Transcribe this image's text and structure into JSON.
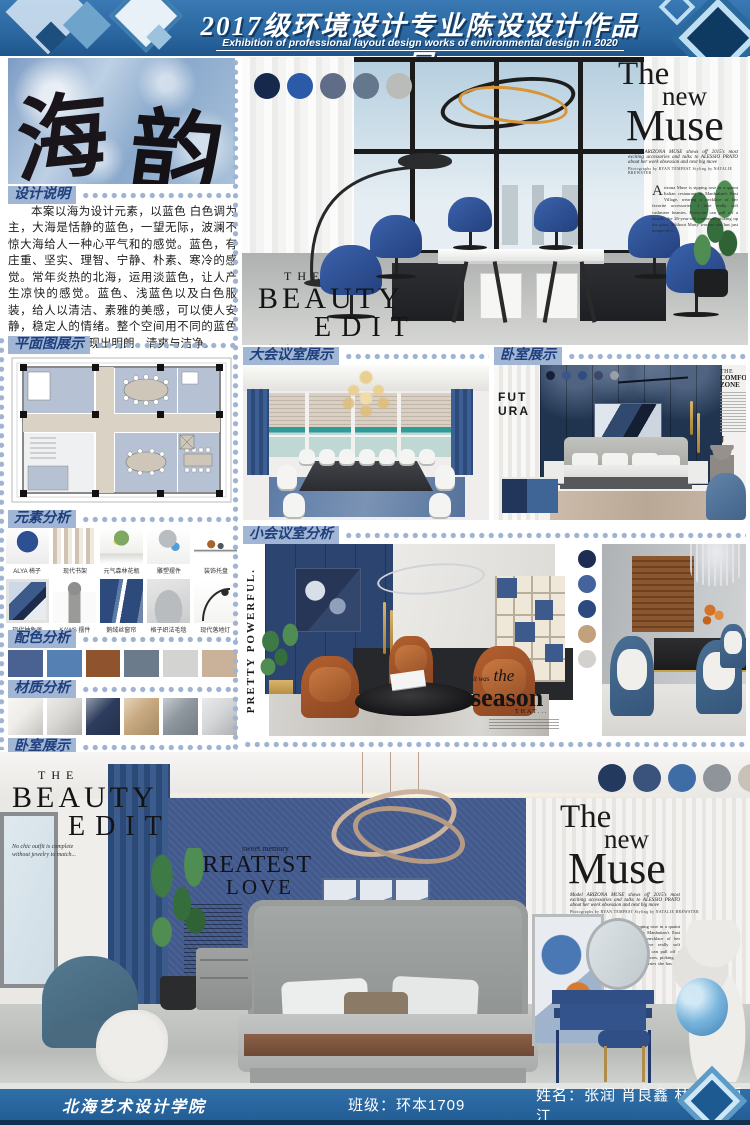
{
  "header": {
    "title": "2017级环境设计专业陈设设计作品展",
    "subtitle": "Exhibition of professional layout design works of environmental design in 2020"
  },
  "hero": {
    "char_left": "海",
    "char_right": "韵"
  },
  "design_notes": {
    "label": "设计说明",
    "body": "本案以海为设计元素，以蓝色 白色调为主，大海是恬静的蓝色，一望无际，波澜不惊大海给人一种心平气和的感觉。蓝色，有庄重、坚实、理智、宁静、朴素、寒冷的感觉。常年炎热的北海，运用淡蓝色，让人产生凉快的感觉。蓝色、浅蓝色以及白色服装，给人以清洁、素雅的美感，可以使人安静，稳定人的情绪。整个空间用不同的蓝色与白色相配，表现出明朗、清爽与洁净。"
  },
  "floor_plan": {
    "label": "平面图展示"
  },
  "elements": {
    "label": "元素分析",
    "items": [
      "ALYA 椅子",
      "现代书架",
      "元气森林花瓶",
      "雕塑摆件",
      "装饰托盘",
      "现代抽象画",
      "KAWS 摆件",
      "鹅绒丝窗帘",
      "格子织法毛毯",
      "现代落地灯"
    ]
  },
  "palette": {
    "label": "配色分析",
    "colors": [
      "#4a6291",
      "#5580b3",
      "#8f532e",
      "#6b7b8c",
      "#d3d3d1",
      "#c9b299"
    ]
  },
  "materials": {
    "label": "材质分析",
    "colors": [
      "#efede9",
      "#d9d7d3",
      "#2c3c5c",
      "#c8a87e",
      "#8e979e",
      "#d4d6d8"
    ]
  },
  "bedroom_preview": {
    "label": "卧室展示"
  },
  "conference_large": {
    "label": "大会议室展示"
  },
  "bedroom_display": {
    "label": "卧室展示"
  },
  "conference_small": {
    "label": "小会议室分析"
  },
  "dots": {
    "office": [
      "#16294d",
      "#2b5ba8",
      "#5f6d89",
      "#64778c",
      "#b9bcb8"
    ],
    "bedroom": [
      "#141f38",
      "#3a568a",
      "#2e4d84",
      "#3c476a",
      "#999fa8"
    ],
    "lounge": [
      "#1e2d53",
      "#44639c",
      "#2c4a80",
      "#c2a27d",
      "#d2d1cd"
    ],
    "master": [
      "#23395e",
      "#3a537c",
      "#3e6da6",
      "#8e9499",
      "#c8c1b7"
    ]
  },
  "magazine": {
    "muse": {
      "w1": "The",
      "w2": "new",
      "w3": "Muse",
      "dek": "Model ARIZONA MUSE shows off 2015's most exciting accessories and talks to ALESSIO PRATO about her work obsession and next big move",
      "credit": "Photographs by RYAN TEMPEST   Styling by NATALIE BREWSTER",
      "dropcap": "A",
      "body": "rizona Muse is sipping rose in a quaint Italian restaurant in Manhattan's East Village, wearing a necklace of her favorite accessories. I love really soft cashmere beanies. Everyone can pull off a beanie, the 26-year-old confesses, picking up the glass. Without Marty worries she has just tempered it."
    },
    "beauty": {
      "w1": "THE",
      "w2": "BEAUTY",
      "w3": "EDIT",
      "caption": "No chic outfit is complete without jewelry to match..."
    },
    "comfort": {
      "w1": "THE",
      "w2": "COMFORT",
      "w3": "ZONE",
      "initial": "J"
    },
    "futura": "FUTURA",
    "pretty": "PRETTY POWERFUL.",
    "season": {
      "pre": "it was",
      "w1": "the",
      "w2": "season",
      "post": "THAT..."
    },
    "greatest": {
      "small": "sweet memory",
      "w1": "GREATEST",
      "w2": "LOVE"
    }
  },
  "footer": {
    "school": "北海艺术设计学院",
    "class_text": "班级：环本1709",
    "names_text": "姓名：张润  肖良鑫  林欣  王禹江"
  }
}
